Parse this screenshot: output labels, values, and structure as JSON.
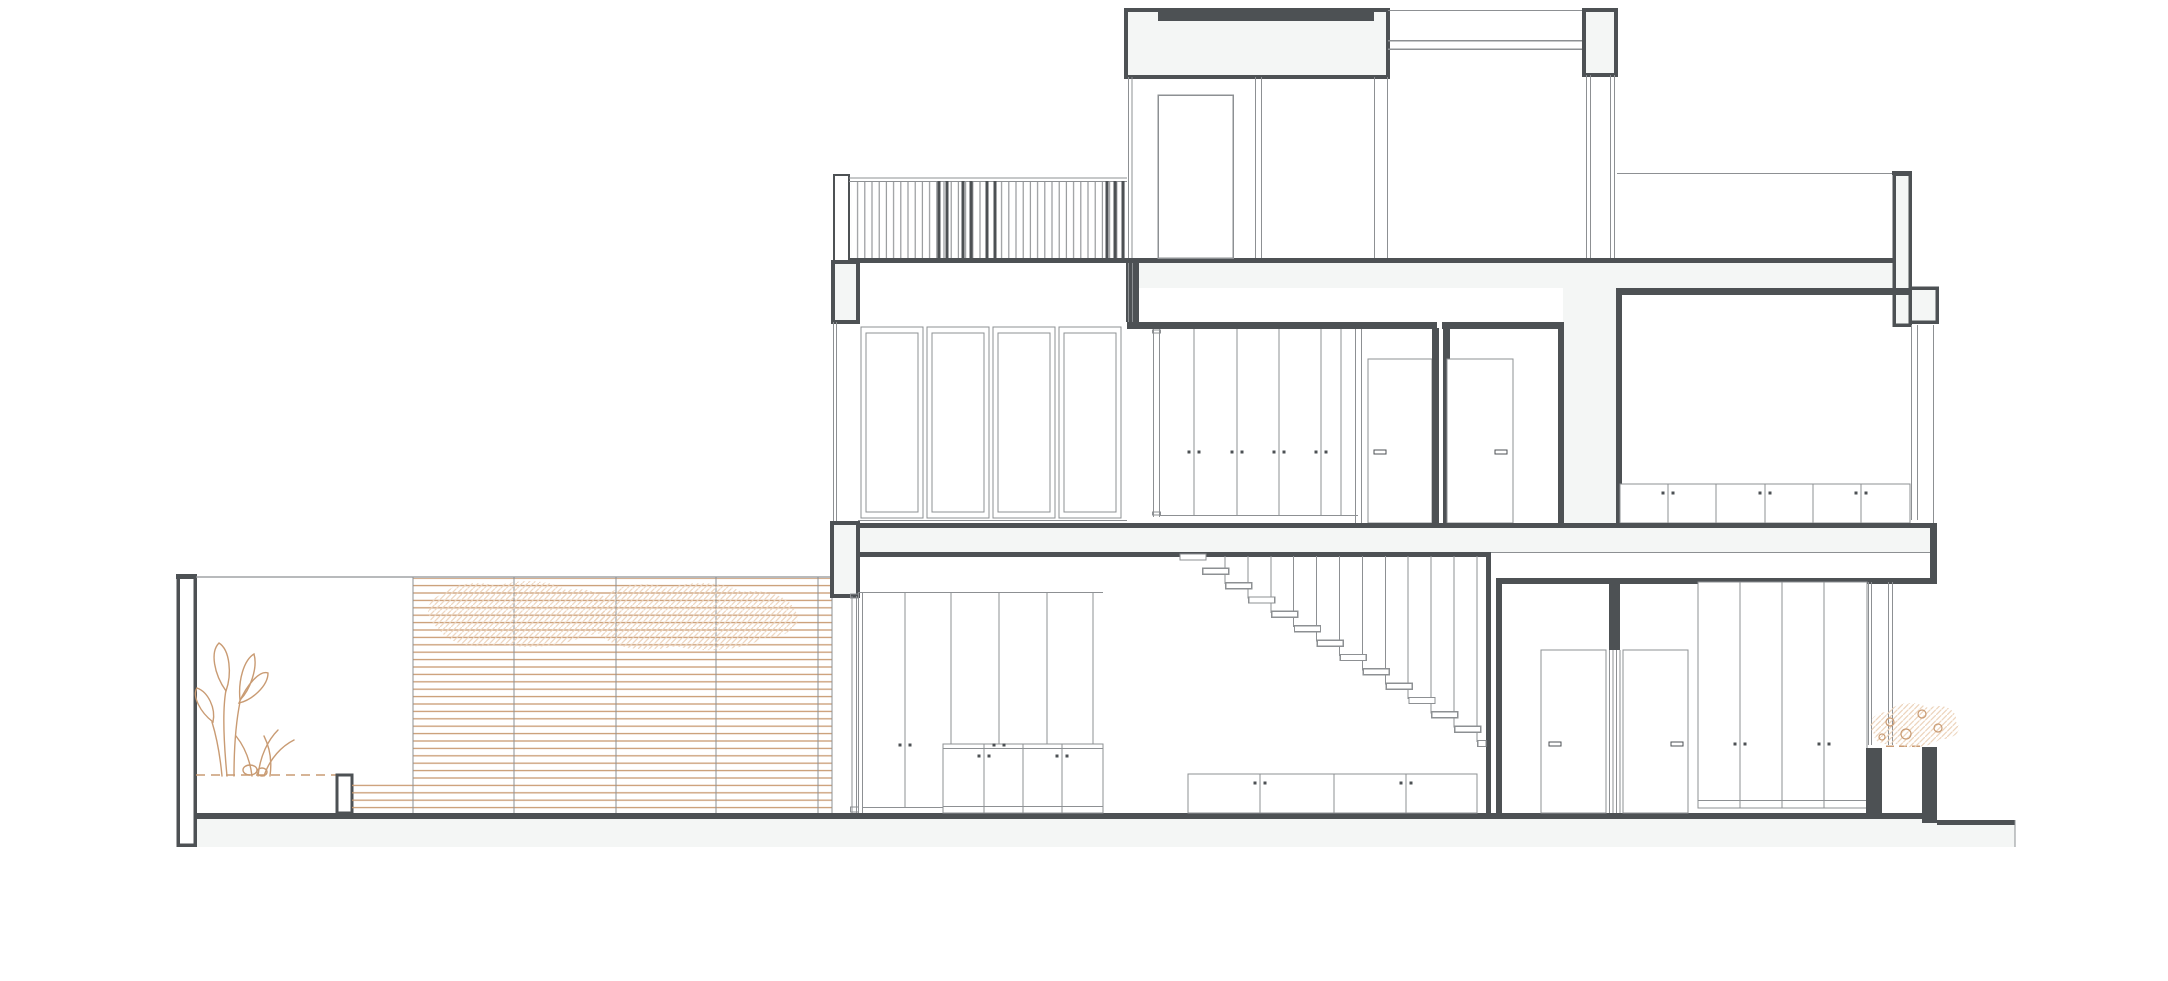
{
  "meta": {
    "drawing_type": "residential building cross-section",
    "sheet": {
      "width_px": 2168,
      "height_px": 981
    }
  },
  "colors": {
    "background": "#ffffff",
    "ink": "#4d5154",
    "hair": "#8d9093",
    "light_fill": "#f4f6f5",
    "tan": "#c99b73",
    "tan_light": "#ecd3ba"
  },
  "drawing": {
    "railing": {
      "slat_area": {
        "x": 851,
        "y": 181,
        "w": 276,
        "h": 77
      },
      "slat_spacing": 7.2,
      "thick_slats": [
        939,
        947,
        963,
        971,
        987,
        995,
        1107,
        1115,
        1123
      ]
    },
    "screen": {
      "posts": [
        413,
        514,
        616,
        716,
        818,
        832
      ],
      "post_top": 577,
      "post_bottom": 813
    },
    "stairs": {
      "tread_count": 14,
      "start_x": 1180,
      "start_y": 554,
      "step_x": 22.9,
      "step_y": 14.35,
      "tread_w": 26,
      "tread_h": 6,
      "ceiling_y": 556,
      "rod_count": 12,
      "rod_start_x": 1225,
      "rod_spacing": 22.9,
      "clip_x": 1486
    },
    "handle_pairs": [
      {
        "y": 452,
        "xs": [
          1194,
          1237,
          1279,
          1321
        ]
      },
      {
        "y": 493,
        "xs": [
          1668,
          1765,
          1861
        ]
      },
      {
        "y": 745,
        "xs": [
          905,
          999
        ]
      },
      {
        "y": 756,
        "xs": [
          984,
          1062
        ]
      },
      {
        "y": 783,
        "xs": [
          1260,
          1406
        ]
      },
      {
        "y": 744,
        "xs": [
          1740,
          1824
        ]
      }
    ],
    "door_handles": [
      {
        "x": 1374,
        "y": 450
      },
      {
        "x": 1495,
        "y": 450
      },
      {
        "x": 1549,
        "y": 742
      },
      {
        "x": 1671,
        "y": 742
      }
    ]
  }
}
